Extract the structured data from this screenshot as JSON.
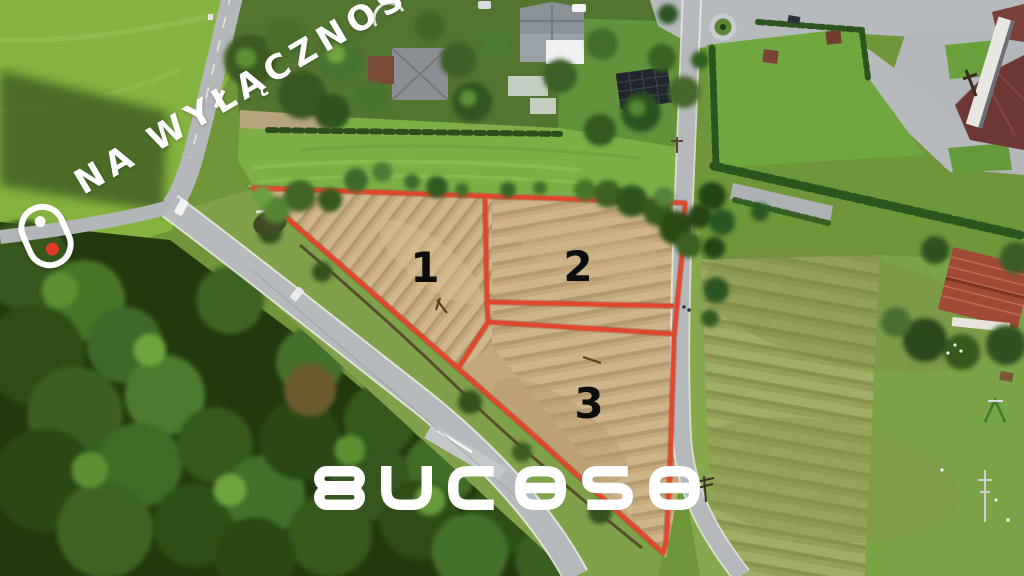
{
  "watermark": {
    "text": "NA WYŁĄCZNOŚĆ"
  },
  "branding": {
    "logo_text": "Bucasa"
  },
  "plots": [
    {
      "label": "1"
    },
    {
      "label": "2"
    },
    {
      "label": "3"
    }
  ],
  "icons": [
    {
      "name": "exclusivity-pin-icon",
      "description": "rounded capsule outline with white dot above red dot"
    }
  ],
  "colors": {
    "boundary_red": "#e2472b",
    "overlay_white": "#ffffff",
    "plot_label_black": "#0d0d0d",
    "pin_dot_red": "#e23b27"
  }
}
